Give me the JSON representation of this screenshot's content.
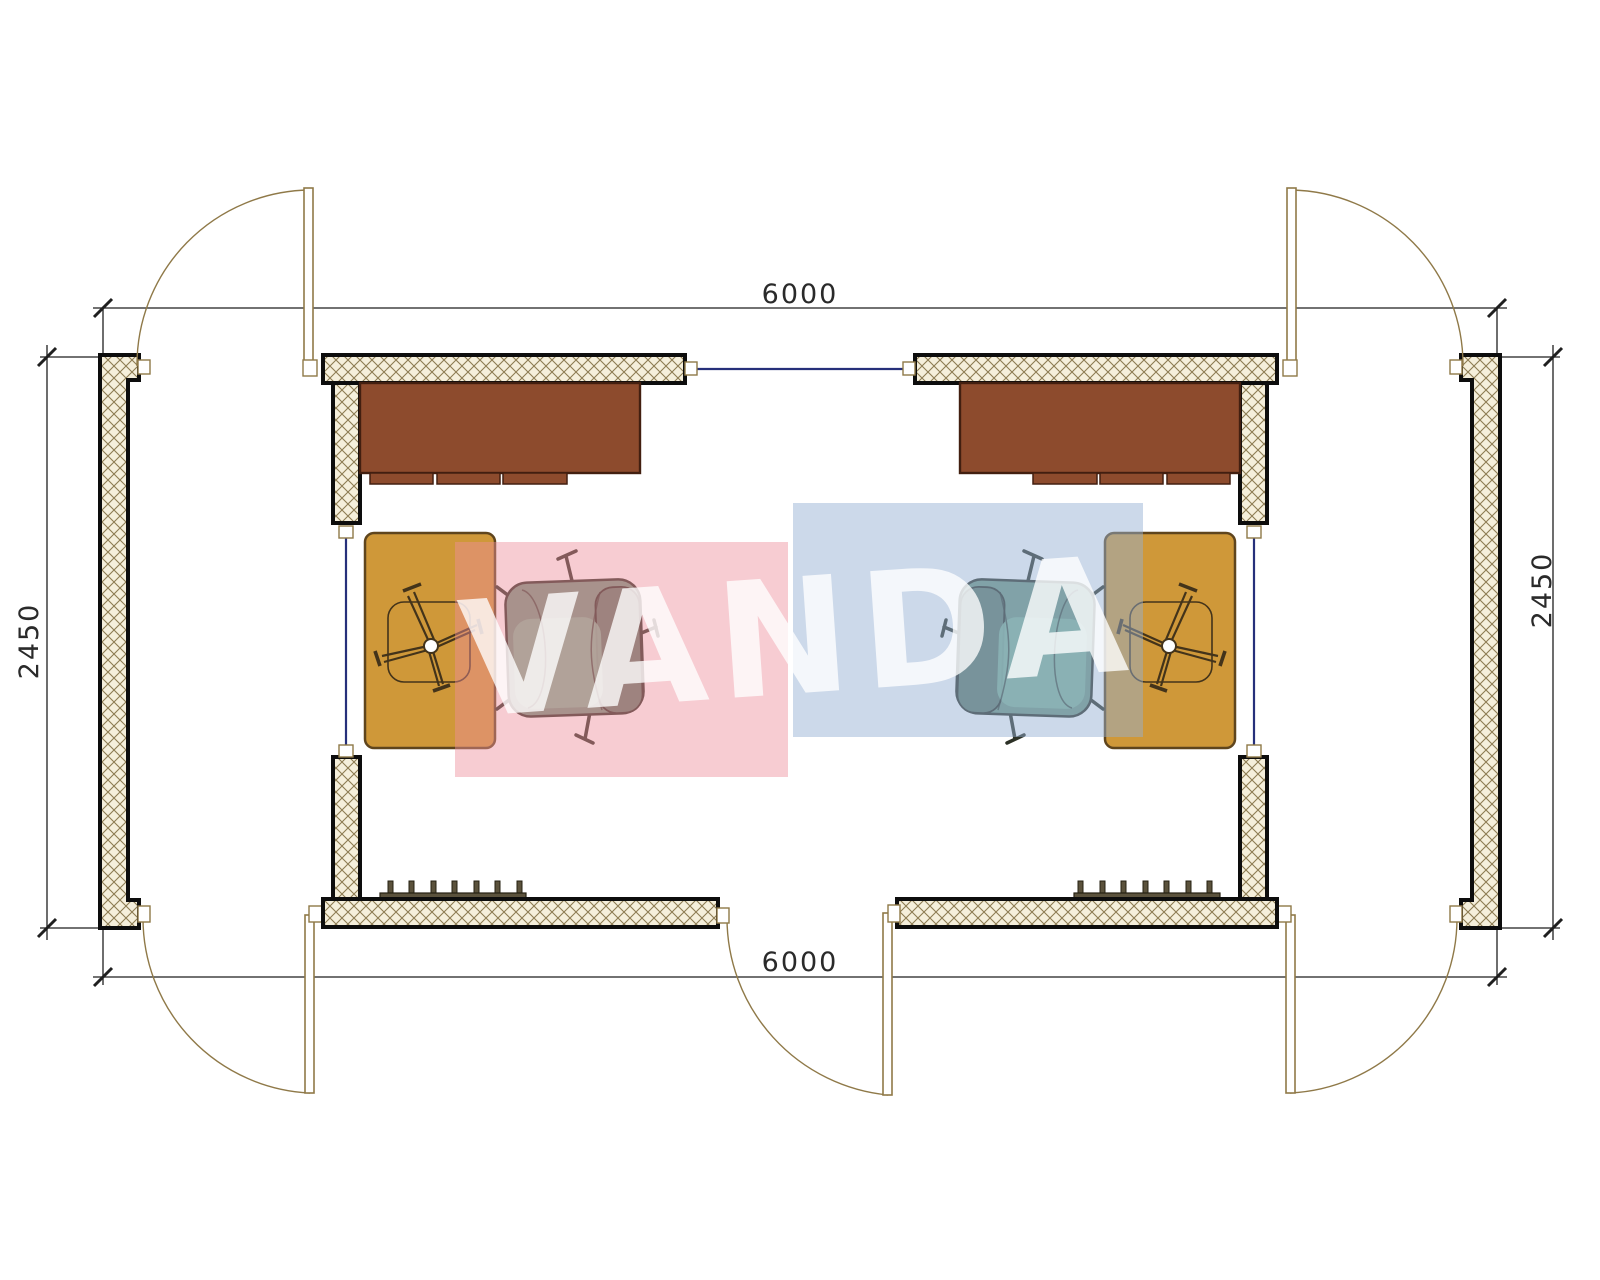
{
  "watermark": {
    "text": "VANDA"
  },
  "dimensions": {
    "top": {
      "label": "6000",
      "value": 6000
    },
    "bottom": {
      "label": "6000",
      "value": 6000
    },
    "left": {
      "label": "2450",
      "value": 2450
    },
    "right": {
      "label": "2450",
      "value": 2450
    }
  },
  "plan": {
    "type": "modular-cabin-floor-plan",
    "footprint": {
      "width": 6000,
      "depth": 2450
    },
    "modules": [
      "left-office",
      "right-office"
    ],
    "door_count": 5,
    "window_count": 3,
    "furniture_per_module": [
      "desk-with-drawers",
      "task-chair-base-on-table",
      "side-table",
      "armchair",
      "convector-heater"
    ]
  },
  "colors": {
    "paper": "#ffffff",
    "wall_fill": "#f5efdb",
    "wall_hatch": "#8d7c52",
    "wall_border": "#0d0d0d",
    "dim": "#1f1f1f",
    "dim_text": "#2a2a2a",
    "door": "#8f7948",
    "window": "#26307a",
    "desk": "#8d4b2d",
    "desk_border": "#421f10",
    "table": "#cf9839",
    "table_border": "#5f451d",
    "chair_body": "#6f9680",
    "chair_dark": "#5e7a68",
    "chair_light": "#82b59a",
    "chair_outline": "#2c3126",
    "star_chair": "#43331a",
    "heater": "#5b523c",
    "heater_border": "#262012",
    "watermark_pink": "rgba(238,142,156,0.45)",
    "watermark_blue": "rgba(148,176,212,0.48)",
    "watermark_text": "rgba(255,255,255,0.78)"
  }
}
